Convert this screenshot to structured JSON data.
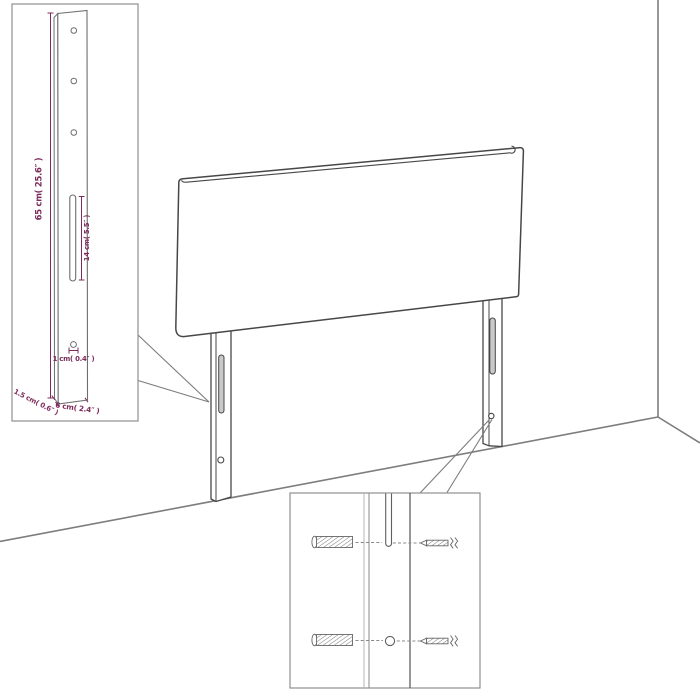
{
  "page": {
    "background": "#ffffff",
    "description": "Technical product diagram of a wall-mounted headboard with two mounting legs shown against a room corner, with a leg dimension inset and a mounting hardware inset"
  },
  "colors": {
    "dimension_accent": "#7d2b5c",
    "drawing_outline": "#474747",
    "wall_line": "#7d7d7d",
    "inset_border": "#8f8f8f",
    "inset_leg_line": "#6e6e6e",
    "hardware_line": "#666666"
  },
  "dimension_inset": {
    "labels": {
      "leg_height": "65 cm( 25.6″ )",
      "slot_length": "14 cm( 5.5″ )",
      "hole_diameter": "1 cm( 0.4″ )",
      "leg_thickness": "1.5 cm( 0.6″ )",
      "leg_width": "6 cm( 2.4″ )"
    }
  },
  "mounting_inset": {
    "hardware": {
      "left_items": "wall-plug-icon",
      "right_items": "screw-icon"
    }
  }
}
